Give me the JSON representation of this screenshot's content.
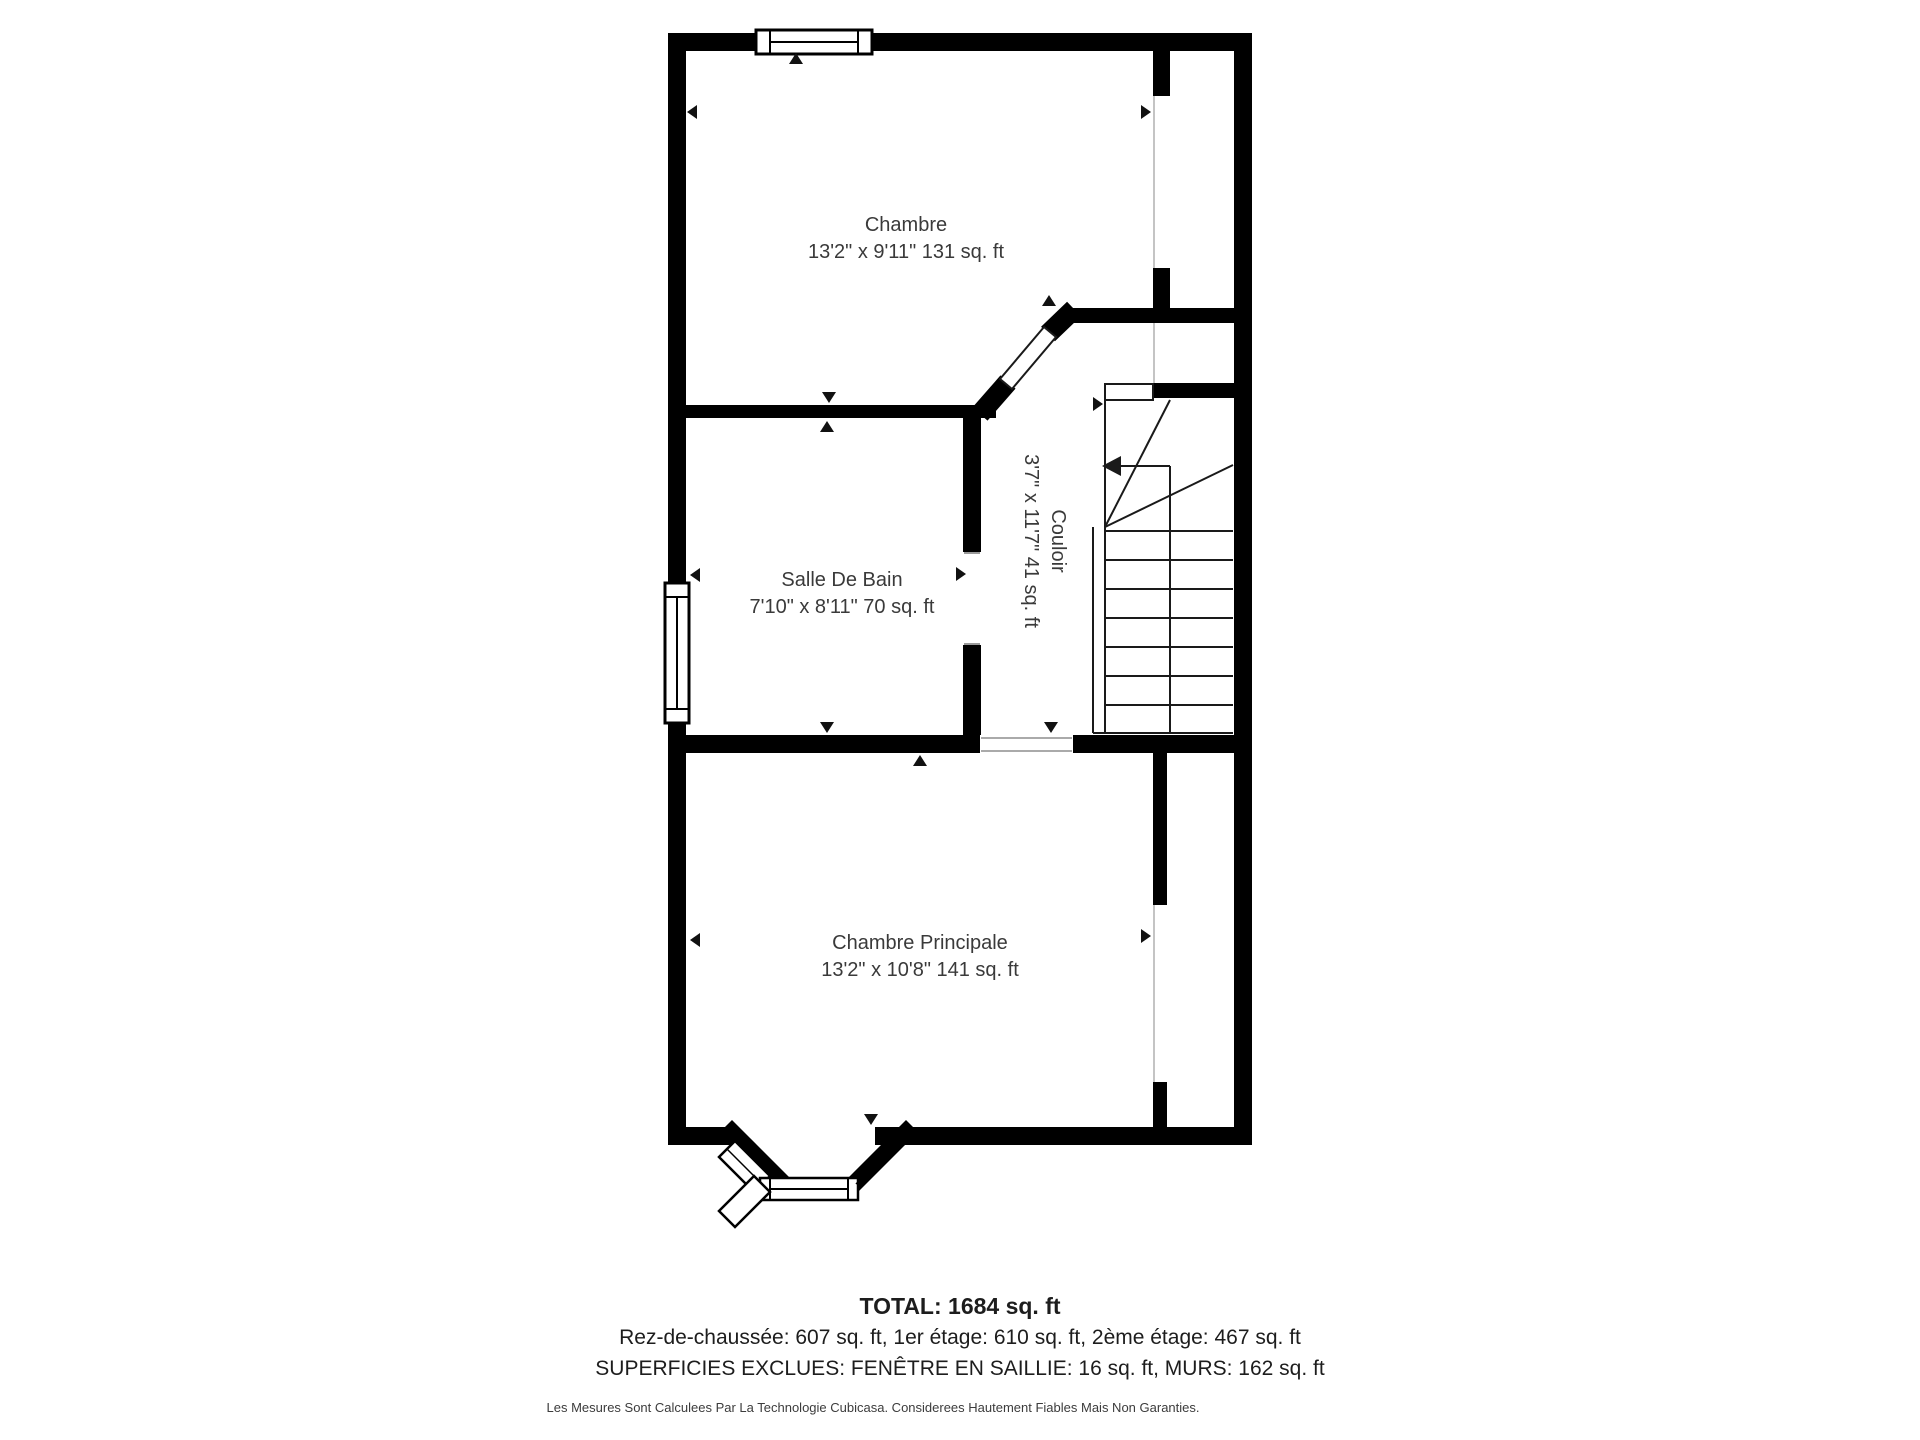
{
  "colors": {
    "wall": "#000000",
    "label_text": "#3a3a3a",
    "footer_text": "#1d1d1d",
    "thin_line": "#c4c4c4",
    "door_line": "#9a9a9a",
    "stair_line": "#1a1a1a",
    "background": "#ffffff"
  },
  "rooms": [
    {
      "id": "chambre",
      "name": "Chambre",
      "dims": "13'2\" x 9'11\" 131 sq. ft"
    },
    {
      "id": "salle-de-bain",
      "name": "Salle De Bain",
      "dims": "7'10\" x 8'11\" 70 sq. ft"
    },
    {
      "id": "couloir",
      "name": "Couloir",
      "dims": "3'7\" x 11'7\" 41 sq. ft"
    },
    {
      "id": "chambre-principale",
      "name": "Chambre Principale",
      "dims": "13'2\" x 10'8\" 141 sq. ft"
    }
  ],
  "footer": {
    "total": "TOTAL: 1684 sq. ft",
    "floors": "Rez-de-chaussée: 607 sq. ft, 1er étage: 610 sq. ft, 2ème étage: 467 sq. ft",
    "exclusions": "SUPERFICIES EXCLUES: FENÊTRE EN SAILLIE: 16 sq. ft, MURS: 162 sq. ft",
    "disclaimer": "Les Mesures Sont Calculees Par La Technologie Cubicasa. Considerees Hautement Fiables Mais Non Garanties."
  }
}
